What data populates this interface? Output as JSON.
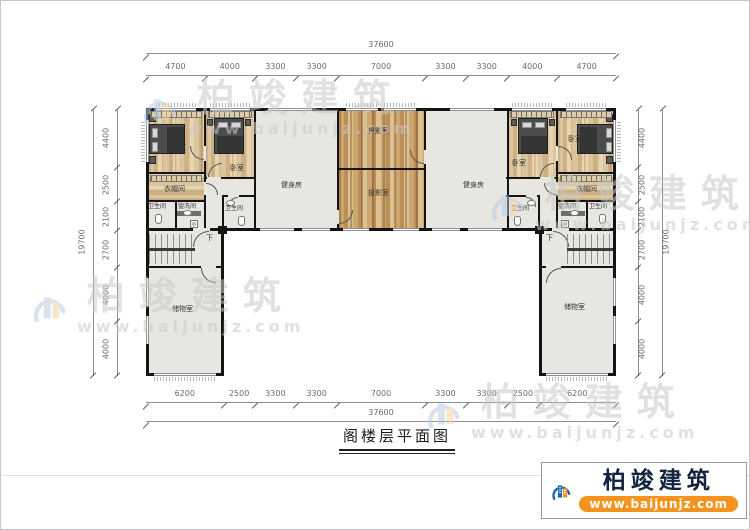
{
  "title": "阁楼层平面图",
  "watermark": {
    "brand": "柏竣建筑",
    "url": "www.baijunjz.com"
  },
  "logo": {
    "brand": "柏竣建筑",
    "url": "www.baijunjz.com"
  },
  "dimensions": {
    "top_total": [
      "37600"
    ],
    "top_segments": [
      "4700",
      "4000",
      "3300",
      "3300",
      "7000",
      "3300",
      "3300",
      "4000",
      "4700"
    ],
    "bottom_segments": [
      "6200",
      "2500",
      "3300",
      "3300",
      "7000",
      "3300",
      "3300",
      "2500",
      "6200"
    ],
    "bottom_total": [
      "37600"
    ],
    "left_total": [
      "19700"
    ],
    "left_segments": [
      "4400",
      "2500",
      "2100",
      "2700",
      "4000",
      "4000"
    ],
    "right_segments": [
      "4400",
      "2500",
      "2100",
      "2700",
      "4000",
      "4000"
    ],
    "right_total": [
      "19700"
    ]
  },
  "rooms": {
    "bedroom": "卧室",
    "cloakroom": "衣帽间",
    "bathroom": "卫生间",
    "washroom": "盥洗间",
    "gym": "健身房",
    "projection": "投影室",
    "storage": "储物室",
    "stairs_down": "下"
  },
  "colors": {
    "wall": "#141414",
    "wood_floor": "#cda56f",
    "plain_floor": "#e7e6e1",
    "accent_orange": "#f6921e",
    "accent_blue": "#1668b1",
    "watermark_gray": "#c9c9c9",
    "dimension_gray": "#8d8d8d"
  }
}
